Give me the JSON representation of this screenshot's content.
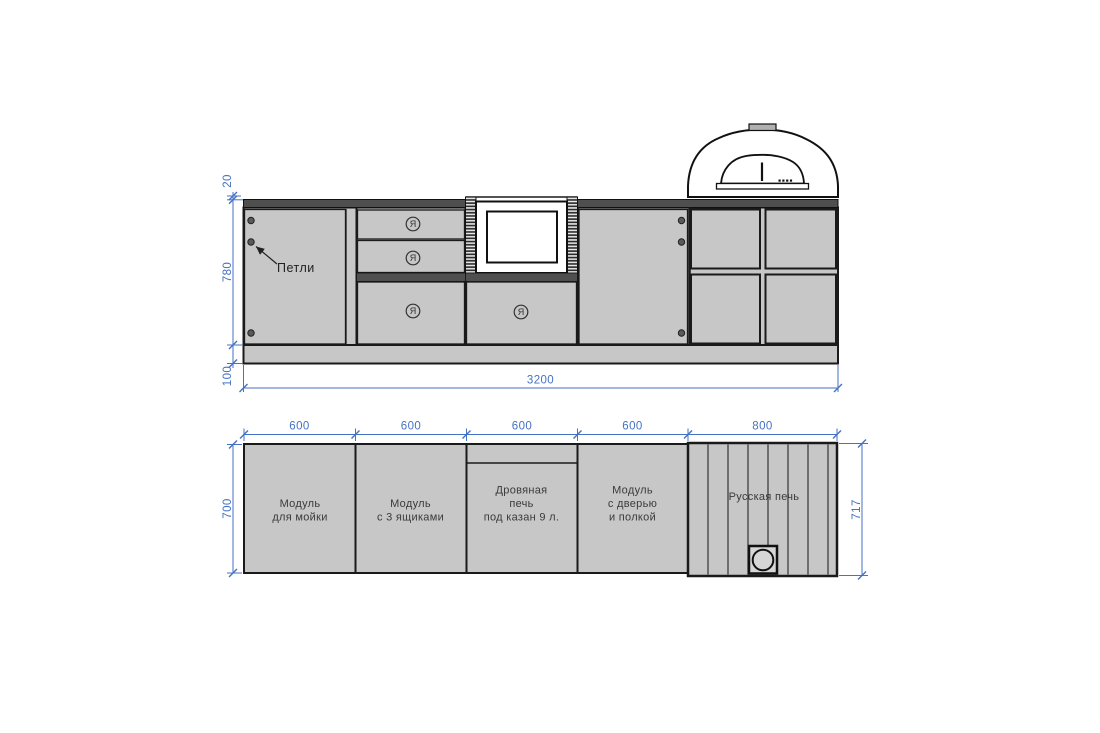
{
  "drawing_title": "Outdoor kitchen technical drawing",
  "colors": {
    "accent_dimension_blue": "#4472c4",
    "cabinet_gray": "#c7c7c7",
    "counter_dark_strip": "#4f4f4f",
    "outline": "#1a1a1a",
    "background": "#ffffff"
  },
  "elevation": {
    "dim_countertop_thickness": "20",
    "dim_cabinet_height": "780",
    "dim_plinth_height": "100",
    "dim_total_width": "3200",
    "hinges_label": "Петли",
    "handle_symbol": "Я"
  },
  "plan": {
    "modules": [
      {
        "name": "sink-module",
        "width": "600",
        "label_lines": [
          "Модуль",
          "для мойки"
        ]
      },
      {
        "name": "drawers-module",
        "width": "600",
        "label_lines": [
          "Модуль",
          "с 3 ящиками"
        ]
      },
      {
        "name": "wood-stove-kazan-module",
        "width": "600",
        "label_lines": [
          "Дровяная",
          "печь",
          "под казан 9 л."
        ]
      },
      {
        "name": "door-shelf-module",
        "width": "600",
        "label_lines": [
          "Модуль",
          "с дверью",
          "и полкой"
        ]
      },
      {
        "name": "russian-stove",
        "width": "800",
        "label_lines": [
          "Русская печь"
        ]
      }
    ],
    "dim_depth_left": "700",
    "dim_depth_right": "717"
  }
}
